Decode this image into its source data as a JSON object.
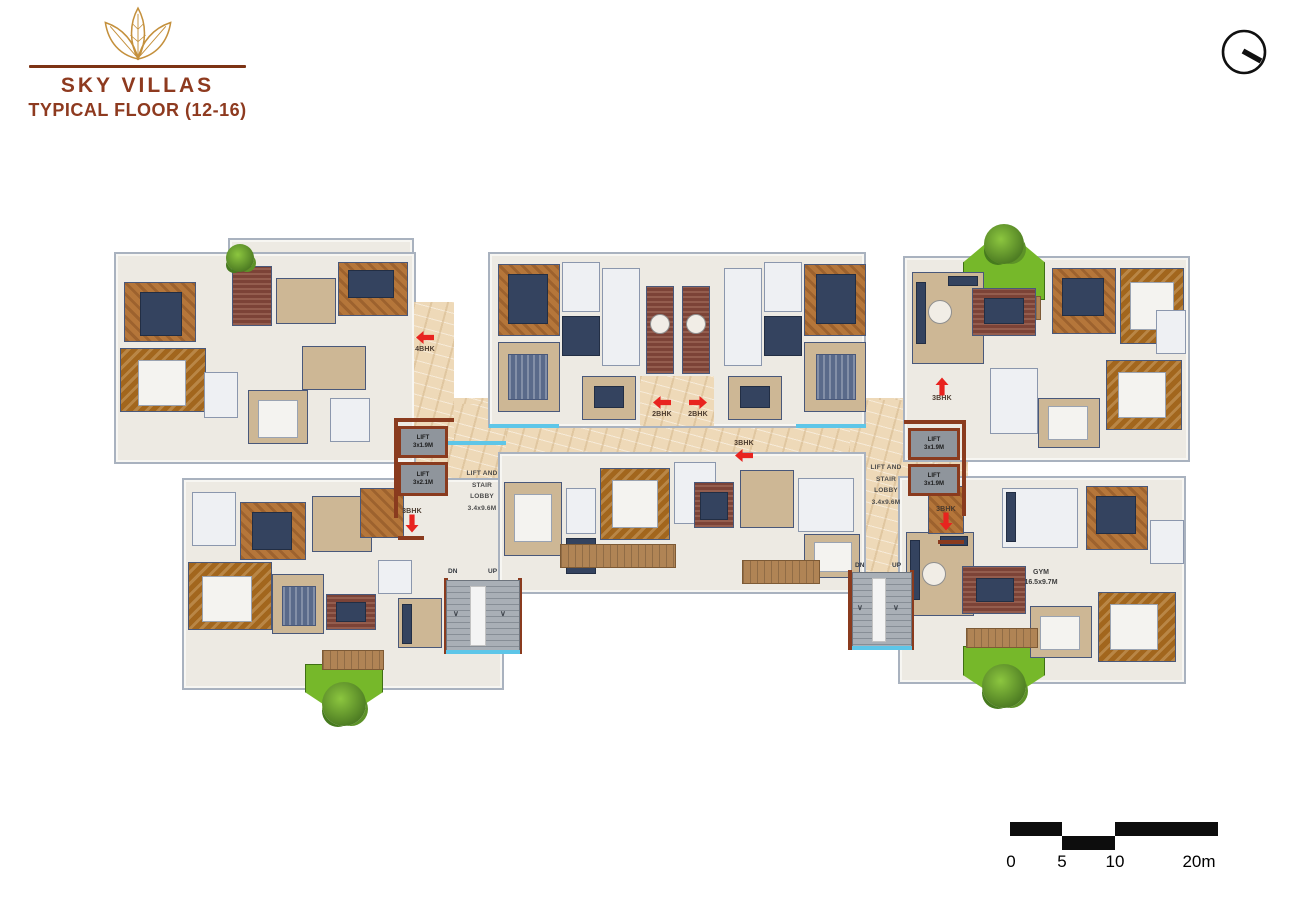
{
  "header": {
    "brand": "SKY VILLAS",
    "subtitle": "TYPICAL FLOOR (12-16)"
  },
  "plan": {
    "lobby_left": {
      "label": "LIFT AND\nSTAIR\nLOBBY\n3.4x9.6M",
      "lift_top": "LIFT\n3x1.9M",
      "lift_bottom": "LIFT\n3x2.1M"
    },
    "lobby_right": {
      "label": "LIFT AND\nSTAIR\nLOBBY\n3.4x9.6M",
      "lift_top": "LIFT\n3x1.9M",
      "lift_bottom": "LIFT\n3x1.9M"
    },
    "markers": {
      "bhk4": {
        "label": "4BHK",
        "dir": "left"
      },
      "bhk2_left": {
        "label": "2BHK",
        "dir": "left"
      },
      "bhk2_right": {
        "label": "2BHK",
        "dir": "right"
      },
      "bhk3_center": {
        "label": "3BHK",
        "dir": "left"
      },
      "bhk3_top_right": {
        "label": "3BHK",
        "dir": "up"
      },
      "bhk3_bottom_left": {
        "label": "3BHK",
        "dir": "down"
      },
      "bhk3_bottom_right": {
        "label": "3BHK",
        "dir": "down"
      }
    },
    "stairs": {
      "dn": "DN",
      "up": "UP"
    },
    "gym": {
      "label": "GYM\n16.5x9.7M"
    }
  },
  "scalebar": {
    "t0": "0",
    "t5": "5",
    "t10": "10",
    "t20": "20m"
  },
  "colors": {
    "brand_brown": "#8e3a1f",
    "logo_gold": "#c4903c",
    "arrow_red": "#e8231f",
    "wall_navy": "#3c4a63",
    "wood": "#b5763a",
    "floor_beige": "#ecd9ba",
    "lift_gray": "#8f959c",
    "lobby_wall_brown": "#8a3b1e",
    "garden_green": "#76b82a",
    "water_cyan": "#5ec6e8"
  }
}
